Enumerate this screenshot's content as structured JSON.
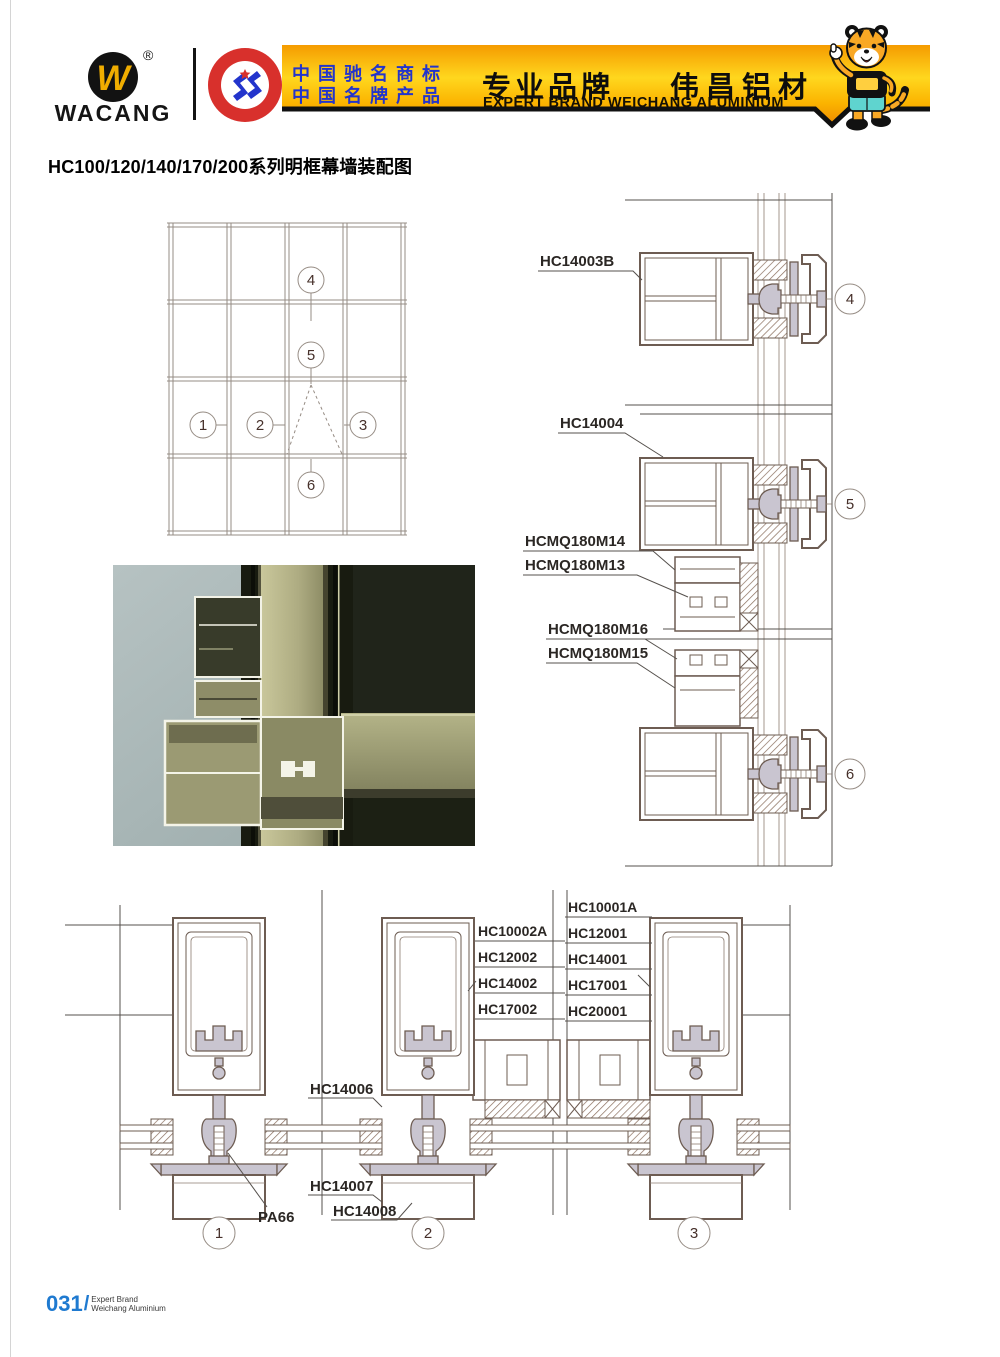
{
  "header": {
    "brand": "WACANG",
    "logo_letter": "W",
    "registered_mark": "®",
    "badge": {
      "arc_top": "中国名牌",
      "arc_bottom": "CHINA TOP BRAND"
    },
    "banner": {
      "cn_line1": "中国驰名商标",
      "cn_line2": "中国名牌产品",
      "headline_left": "专业品牌",
      "headline_right": "伟昌铝材",
      "subtitle": "EXPERT BRAND WEICHANG ALUMINIUM"
    }
  },
  "title": "HC100/120/140/170/200系列明框幕墙装配图",
  "elevation": {
    "callouts": [
      "1",
      "2",
      "3",
      "4",
      "5",
      "6"
    ]
  },
  "right_details": {
    "d4_label": "HC14003B",
    "d5_label": "HC14004",
    "d5_sub_labels": [
      "HCMQ180M14",
      "HCMQ180M13"
    ],
    "d6_sub_labels": [
      "HCMQ180M16",
      "HCMQ180M15"
    ]
  },
  "bottom_details": {
    "pa66_label": "PA66",
    "hc14006_label": "HC14006",
    "hc14007_label": "HC14007",
    "hc14008_label": "HC14008",
    "stack_2": [
      "HC10002A",
      "HC12002",
      "HC14002",
      "HC17002"
    ],
    "stack_3": [
      "HC10001A",
      "HC12001",
      "HC14001",
      "HC17001",
      "HC20001"
    ]
  },
  "footer": {
    "page_number": "031",
    "separator": "/",
    "caption_line1": "Expert Brand",
    "caption_line2": "Weichang Aluminium"
  },
  "colors": {
    "banner_gold": "#ffd71e",
    "banner_border": "#101010",
    "badge_red": "#d8302c",
    "cn_blue": "#2334cc",
    "line_brown": "#6d5c52",
    "profile_fill": "#c9c5d0",
    "callout_text": "#46302a",
    "footer_blue": "#1f7ad0"
  }
}
